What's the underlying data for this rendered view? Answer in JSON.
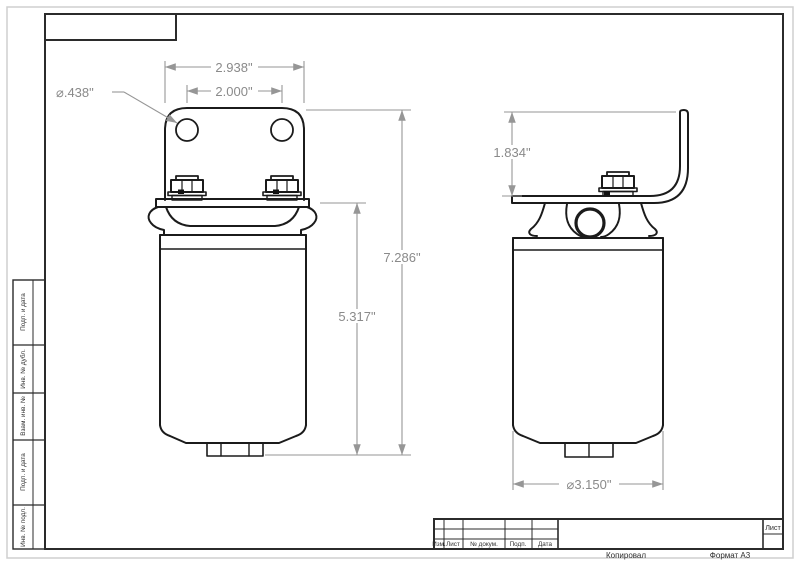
{
  "drawing": {
    "type": "technical-drawing",
    "sheet_format": "A3",
    "dims": {
      "bracket_width": "2.938\"",
      "hole_spacing": "2.000\"",
      "hole_diameter": "⌀.438\"",
      "overall_height": "7.286\"",
      "body_height": "5.317\"",
      "bracket_height": "1.834\"",
      "body_diameter": "⌀3.150\""
    },
    "frame": {
      "side_labels": [
        "Подп. и дата",
        "Инв. № дубл.",
        "Взам. инв. №",
        "Подп. и дата",
        "Инв. № подл."
      ],
      "title_block": {
        "cols": [
          "Изм.",
          "Лист",
          "№ докум.",
          "Подп.",
          "Дата"
        ],
        "sheet_label": "Лист"
      },
      "footer": {
        "copied": "Копировал",
        "format": "Формат А3"
      }
    },
    "colors": {
      "part_line": "#1b1b1b",
      "dimension_line": "#969696",
      "dimension_text": "#8a8a8a",
      "frame_line": "#2b2b2b"
    }
  }
}
